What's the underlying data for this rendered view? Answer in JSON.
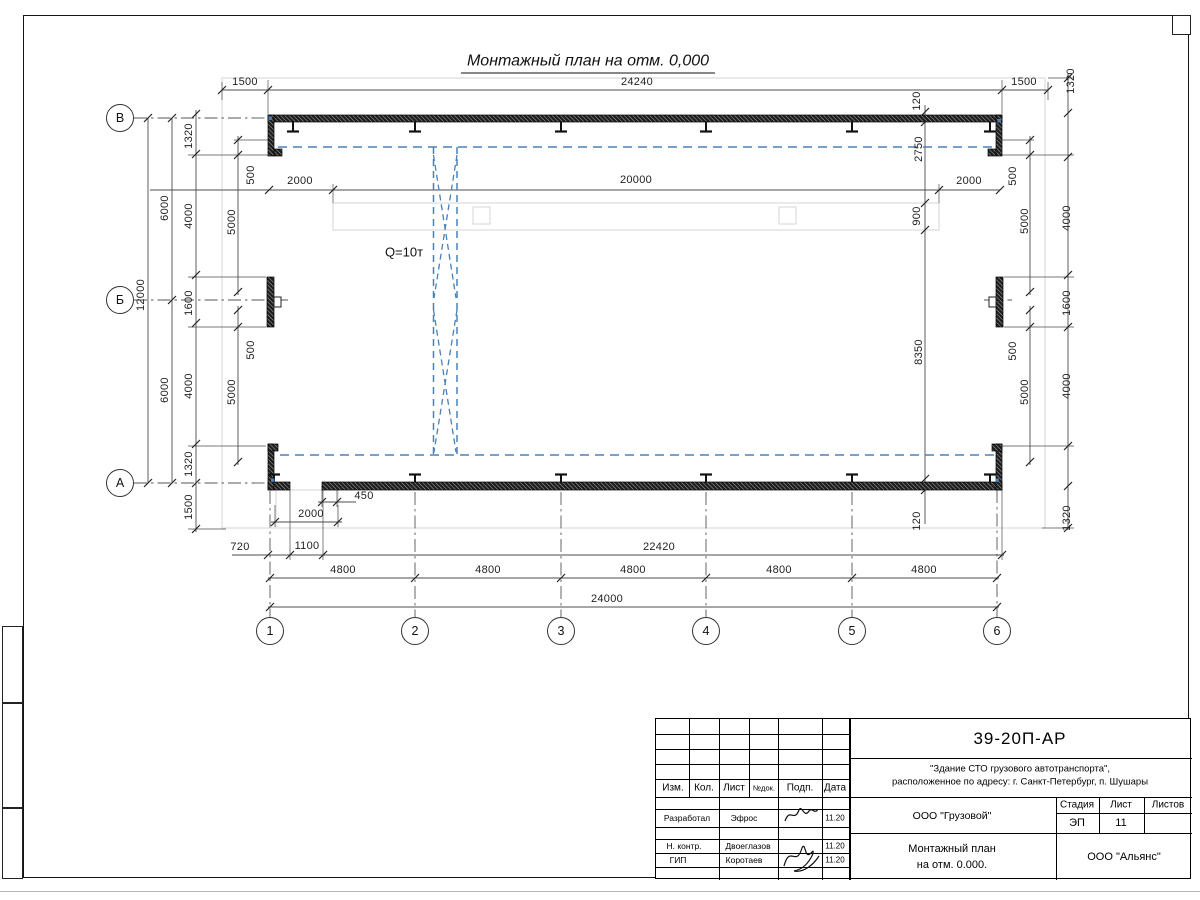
{
  "title": "Монтажный план на отм. 0,000",
  "crane_label": "Q=10т",
  "colors": {
    "accent_blue": "#4a80b8",
    "wall": "#1e1e1e",
    "underlay": "#d9d9d9"
  },
  "axes": {
    "rows": [
      "В",
      "Б",
      "А"
    ],
    "cols": [
      "1",
      "2",
      "3",
      "4",
      "5",
      "6"
    ]
  },
  "dims": {
    "t1500L": "1500",
    "t24240": "24240",
    "t1500R": "1500",
    "r2000L": "2000",
    "r20000": "20000",
    "r2000R": "2000",
    "L12000": "12000",
    "L6000a": "6000",
    "L6000b": "6000",
    "Li1320a": "1320",
    "Li4000a": "4000",
    "Li1600": "1600",
    "Li4000b": "4000",
    "Li1320b": "1320",
    "Li1500": "1500",
    "Lc500a": "500",
    "Lc5000a": "5000",
    "Lc500b": "500",
    "Lc5000b": "5000",
    "Ri120a": "120",
    "Ri2750": "2750",
    "Ri900": "900",
    "Ri8350": "8350",
    "Ri120b": "120",
    "Rc500a": "500",
    "Rc5000a": "5000",
    "Rc500b": "500",
    "Rc5000b": "5000",
    "Ro1320a": "1320",
    "Ro4000a": "4000",
    "Ro1600": "1600",
    "Ro4000b": "4000",
    "Ro1320b": "1320",
    "b450": "450",
    "b2000": "2000",
    "b720": "720",
    "b1100": "1100",
    "b22420": "22420",
    "b4800a": "4800",
    "b4800b": "4800",
    "b4800c": "4800",
    "b4800d": "4800",
    "b4800e": "4800",
    "b24000": "24000"
  },
  "stamp": {
    "code": "39-20П-АР",
    "project_line1": "\"Здание СТО грузового автотранспорта\",",
    "project_line2": "расположенное по адресу: г. Санкт-Петербург, п. Шушары",
    "columns": {
      "izm": "Изм.",
      "kol": "Кол.",
      "list": "Лист",
      "ndoc": "№док.",
      "podp": "Подп.",
      "data": "Дата"
    },
    "rows": [
      {
        "role": "Разработал",
        "name": "Эфрос",
        "date": "11.20"
      },
      {
        "role": "Н. контр.",
        "name": "Двоеглазов",
        "date": "11.20"
      },
      {
        "role": "ГИП",
        "name": "Коротаев",
        "date": "11.20"
      }
    ],
    "org": "ООО \"Грузовой\"",
    "stage_label": "Стадия",
    "sheet_label": "Лист",
    "sheets_label": "Листов",
    "stage": "ЭП",
    "sheet": "11",
    "doc_title_line1": "Монтажный план",
    "doc_title_line2": "на отм. 0.000.",
    "company": "ООО \"Альянс\""
  }
}
